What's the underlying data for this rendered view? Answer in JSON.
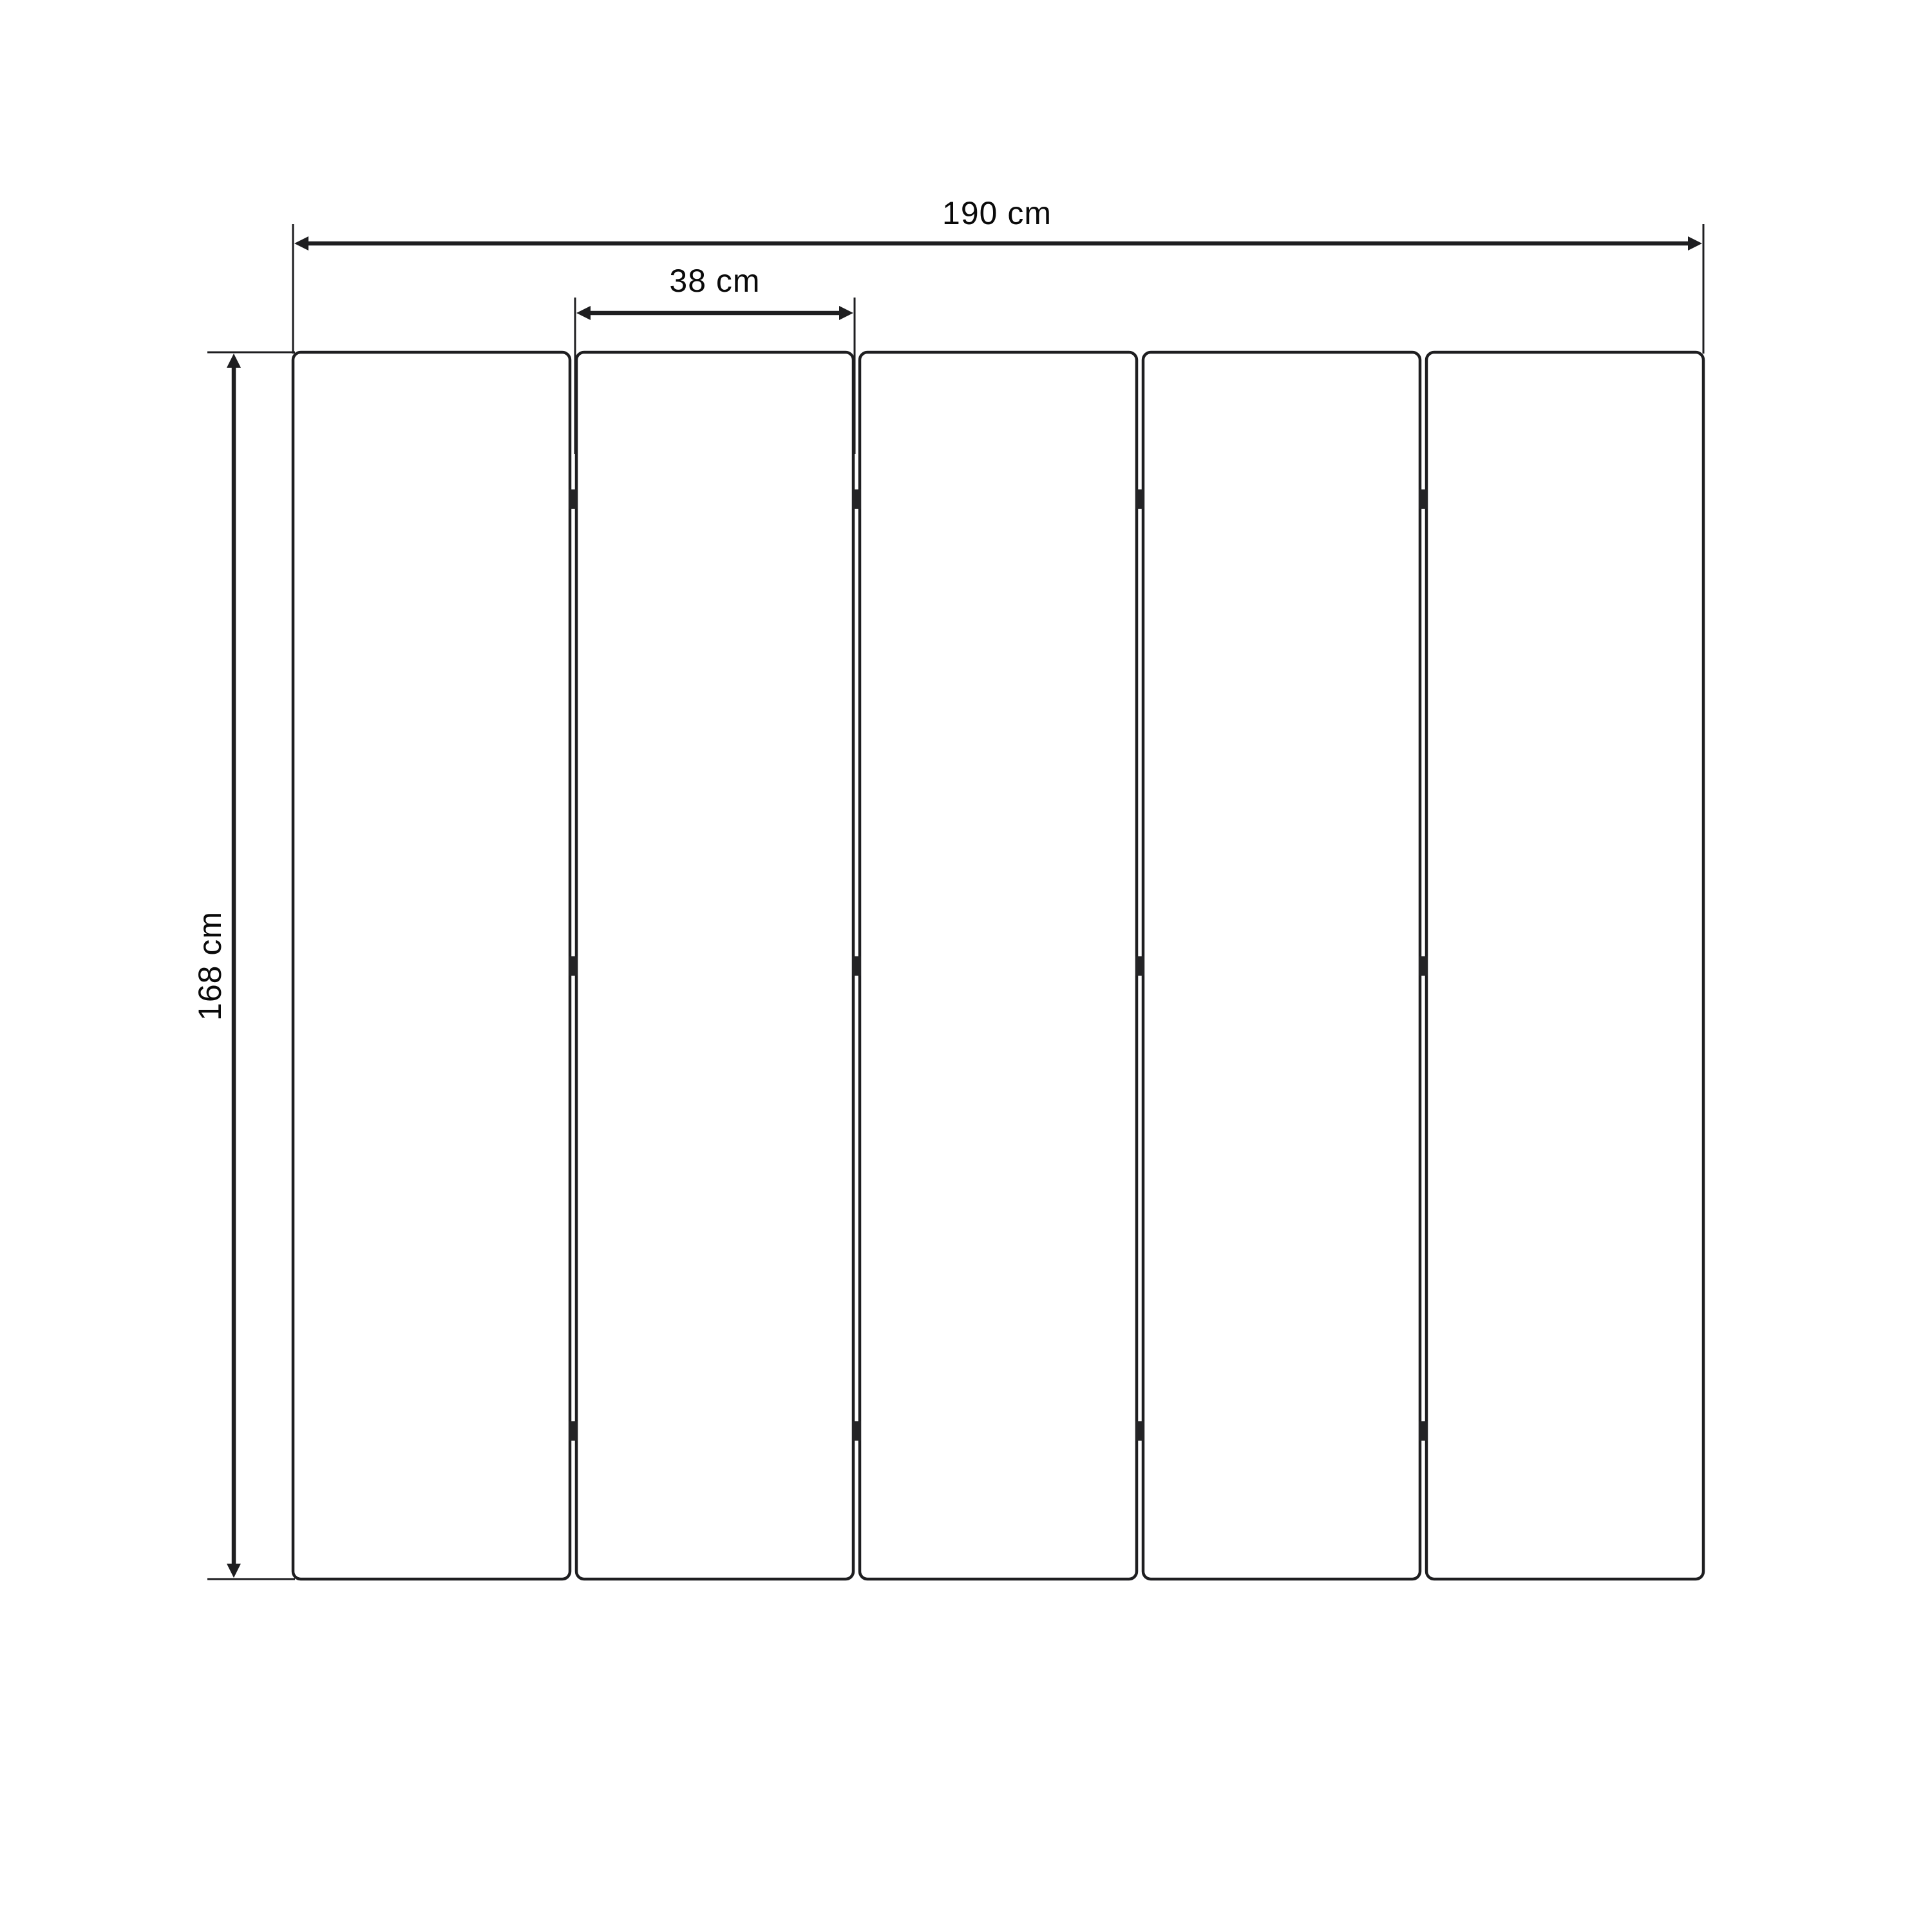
{
  "diagram": {
    "kind": "folding-screen-dimension-drawing",
    "panel_count": 5,
    "hinge_rows": 3,
    "hinges_per_junction": 3,
    "dimensions": {
      "total_width": {
        "label": "190 cm",
        "value": 190,
        "unit": "cm"
      },
      "panel_width": {
        "label": "38 cm",
        "value": 38,
        "unit": "cm"
      },
      "height": {
        "label": "168 cm",
        "value": 168,
        "unit": "cm"
      }
    },
    "colors": {
      "background": "#ffffff",
      "line": "#1e1e20",
      "text": "#0a0a0a"
    }
  }
}
